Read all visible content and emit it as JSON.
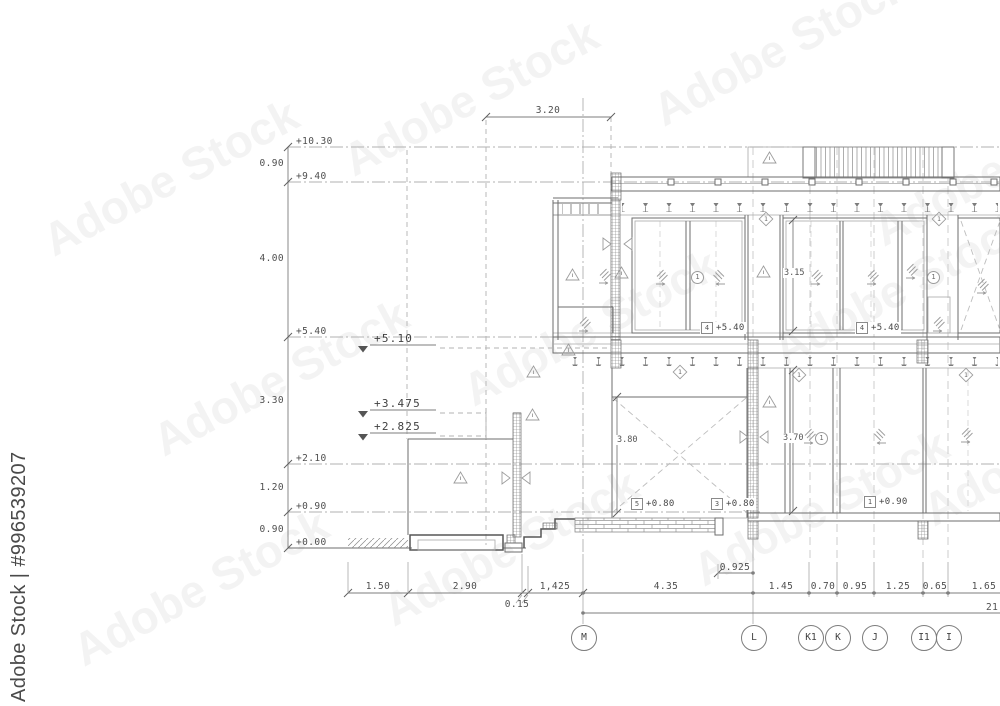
{
  "watermark": {
    "stock": "Adobe Stock",
    "id": "Adobe Stock | #996539207"
  },
  "left_levels": [
    "+10.30",
    "+9.40",
    "+5.40",
    "+2.10",
    "+0.90",
    "+0.00"
  ],
  "left_segments": [
    "0.90",
    "4.00",
    "3.30",
    "1.20",
    "0.90"
  ],
  "level_markers": [
    "+5.10",
    "+3.475",
    "+2.825"
  ],
  "dims": {
    "top": "3.20",
    "window_upper": "3.15",
    "opening": "3.80",
    "window_lower": "3.70",
    "offset": "0.925",
    "threshold": "0.15",
    "total": "21"
  },
  "bottom_dims": [
    "1.50",
    "2.90",
    "1,425",
    "4.35",
    "1.45",
    "0.70",
    "0.95",
    "1.25",
    "0.65",
    "1.65"
  ],
  "floor_tags": [
    {
      "n": "4",
      "v": "+5.40"
    },
    {
      "n": "4",
      "v": "+5.40"
    },
    {
      "n": "5",
      "v": "+0.80"
    },
    {
      "n": "3",
      "v": "+0.80"
    },
    {
      "n": "1",
      "v": "+0.90"
    }
  ],
  "ref_circles": [
    "1",
    "1",
    "1"
  ],
  "ref_diamonds": [
    "1",
    "1",
    "1",
    "1",
    "1"
  ],
  "grid_labels": [
    "M",
    "L",
    "K1",
    "K",
    "J",
    "I1",
    "I"
  ]
}
